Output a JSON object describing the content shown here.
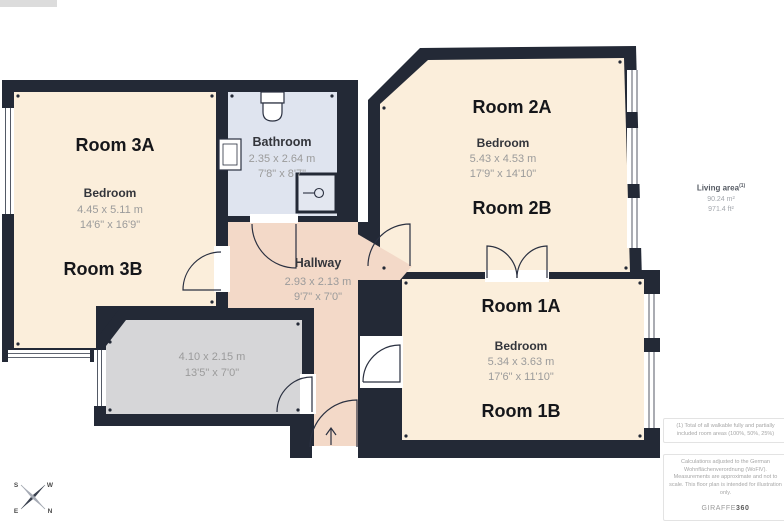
{
  "colors": {
    "wall": "#232936",
    "room_fill": "#fbeedb",
    "bathroom_fill": "#dfe4ef",
    "hallway_fill": "#f3d9c8",
    "balcony_fill": "#d6d6d8"
  },
  "plan": {
    "room3": {
      "label_top": "Room 3A",
      "label_bottom": "Room 3B",
      "type": "Bedroom",
      "dim_m": "4.45 x 5.11 m",
      "dim_ft": "14'6\" x 16'9\""
    },
    "room2": {
      "label_top": "Room 2A",
      "label_bottom": "Room 2B",
      "type": "Bedroom",
      "dim_m": "5.43 x 4.53 m",
      "dim_ft": "17'9\" x 14'10\""
    },
    "room1": {
      "label_top": "Room 1A",
      "label_bottom": "Room 1B",
      "type": "Bedroom",
      "dim_m": "5.34 x 3.63 m",
      "dim_ft": "17'6\" x 11'10\""
    },
    "bathroom": {
      "label": "Bathroom",
      "dim_m": "2.35 x 2.64 m",
      "dim_ft": "7'8\" x 8'7\""
    },
    "hallway": {
      "label": "Hallway",
      "dim_m": "2.93 x 2.13 m",
      "dim_ft": "9'7\" x 7'0\""
    },
    "balcony": {
      "dim_m": "4.10 x 2.15 m",
      "dim_ft": "13'5\" x 7'0\""
    }
  },
  "sidebar": {
    "living_area_label": "Living area",
    "living_area_sup": "(1)",
    "area_m2": "90.24 m²",
    "area_ft2": "971.4 ft²"
  },
  "footnotes": {
    "note1": "(1) Total of all walkable fully and partially included room areas (100%, 50%, 25%)",
    "disclaimer": "Calculations adjusted to the German Wohnflächenverordnung (WoFlV). Measurements are approximate and not to scale. This floor plan is intended for illustration only.",
    "logo_left": "GIRAFFE",
    "logo_right": "360"
  },
  "compass": {
    "s": "S",
    "w": "W",
    "e": "E",
    "n": "N"
  }
}
